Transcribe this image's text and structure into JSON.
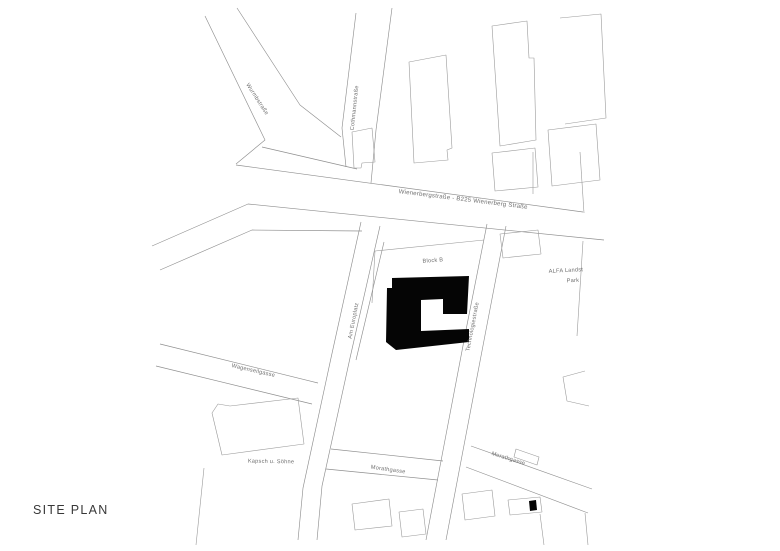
{
  "page": {
    "title": "SITE PLAN"
  },
  "map": {
    "street_labels": [
      {
        "id": "wurmbstrasse",
        "text": "Wurmbstraße"
      },
      {
        "id": "cothmannstrasse",
        "text": "Cothmannstraße"
      },
      {
        "id": "wienerbergstrasse",
        "text": "Wienerbergstraße - B225 Wienerberg Straße"
      },
      {
        "id": "am-europlatz",
        "text": "Am Europlatz"
      },
      {
        "id": "technologiestrasse",
        "text": "Technologiestraße"
      },
      {
        "id": "wagenseilgasse",
        "text": "Wagenseilgasse"
      },
      {
        "id": "morathgasse-west",
        "text": "Morathgasse"
      },
      {
        "id": "morathgasse-east",
        "text": "Morathgasse"
      }
    ],
    "place_labels": [
      {
        "id": "block-b",
        "text": "Block B"
      },
      {
        "id": "alfa-park-line1",
        "text": "ALFA Landst"
      },
      {
        "id": "alfa-park-line2",
        "text": "Park"
      },
      {
        "id": "kapsch",
        "text": "Kapsch u. Söhne"
      }
    ],
    "colors": {
      "site_building_fill": "#050505",
      "linework": "#8f8f8f",
      "label_text": "#6e6e6e",
      "title_text": "#383838",
      "background": "#ffffff"
    }
  }
}
